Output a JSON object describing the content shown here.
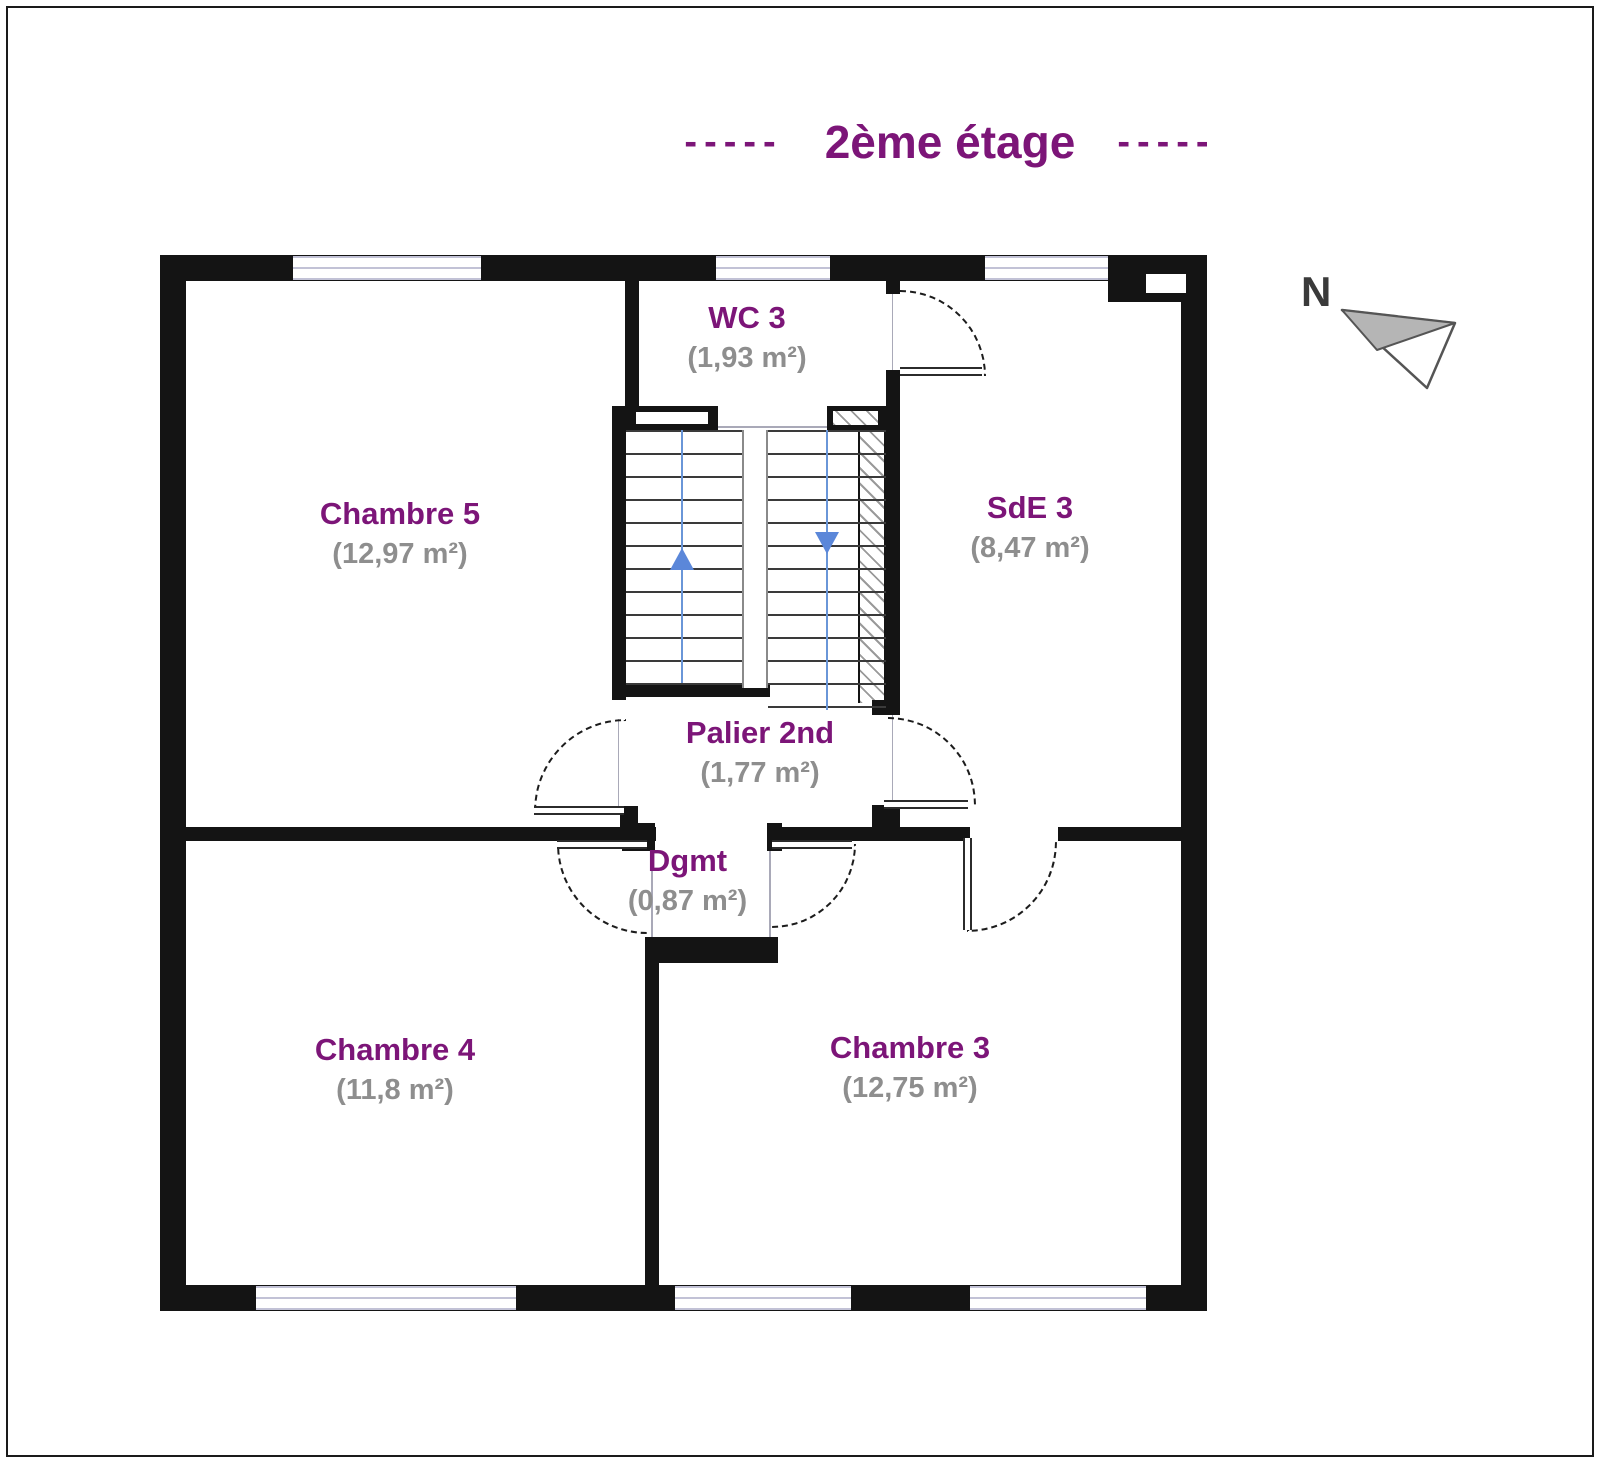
{
  "title": {
    "left_dashes": "-----",
    "text": "2ème étage",
    "right_dashes": "-----"
  },
  "compass": {
    "label": "N"
  },
  "rooms": [
    {
      "name": "Chambre 5",
      "area": "(12,97 m²)"
    },
    {
      "name": "WC 3",
      "area": "(1,93 m²)"
    },
    {
      "name": "SdE 3",
      "area": "(8,47 m²)"
    },
    {
      "name": "Palier 2nd",
      "area": "(1,77 m²)"
    },
    {
      "name": "Dgmt",
      "area": "(0,87 m²)"
    },
    {
      "name": "Chambre 4",
      "area": "(11,8 m²)"
    },
    {
      "name": "Chambre 3",
      "area": "(12,75 m²)"
    }
  ],
  "stairs": {
    "up_arrow": "up",
    "down_arrow": "down"
  },
  "colors": {
    "title": "#7c1578",
    "room_name": "#7c1578",
    "area_text": "#8e8e8e",
    "wall": "#141414",
    "stair_accent": "#5b87d9",
    "window_line": "#c2c2d6"
  }
}
